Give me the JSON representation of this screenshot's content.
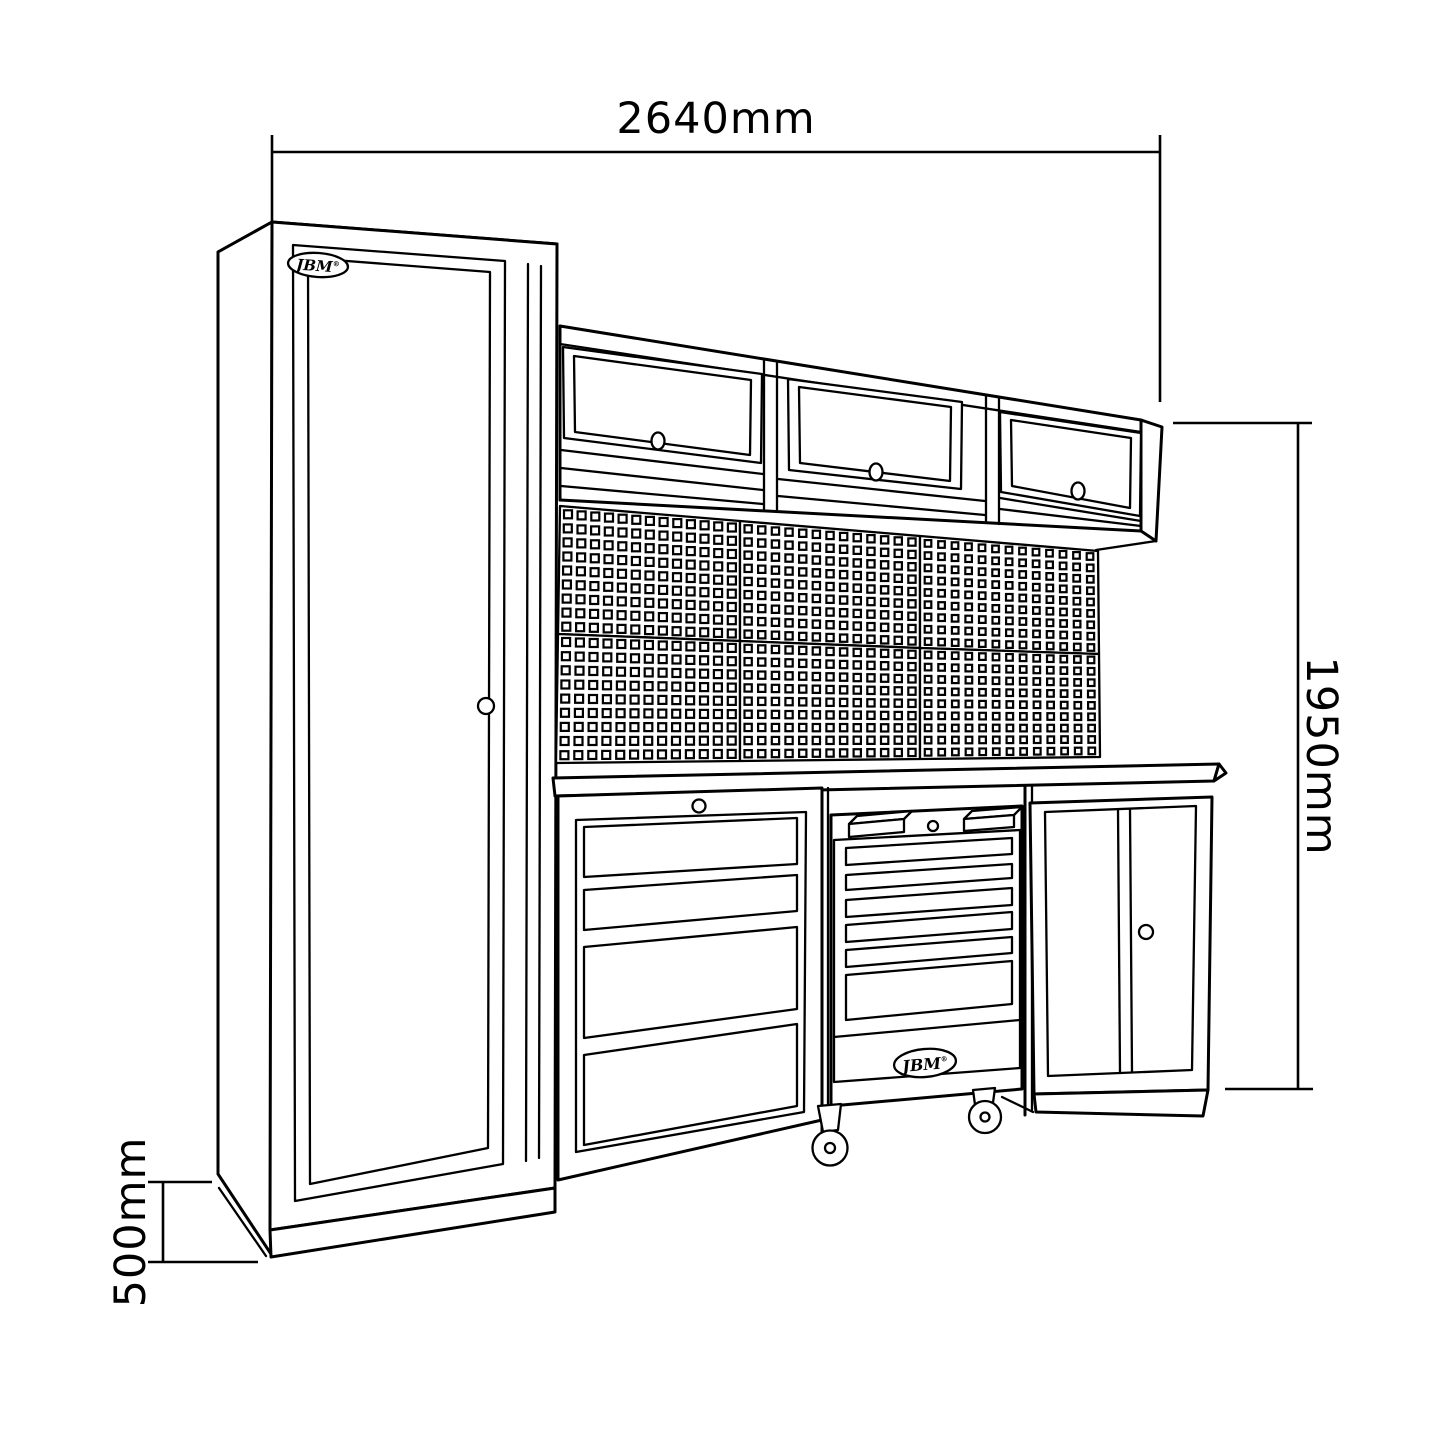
{
  "drawing": {
    "title": "JBM modular workshop cabinet dimension drawing",
    "brand_logo": "JBM",
    "registered_mark": "®",
    "dimensions": {
      "overall_width": "2640mm",
      "overall_height": "1950mm",
      "base_depth": "500mm"
    },
    "colors": {
      "line": "#000000",
      "background": "#ffffff"
    }
  }
}
